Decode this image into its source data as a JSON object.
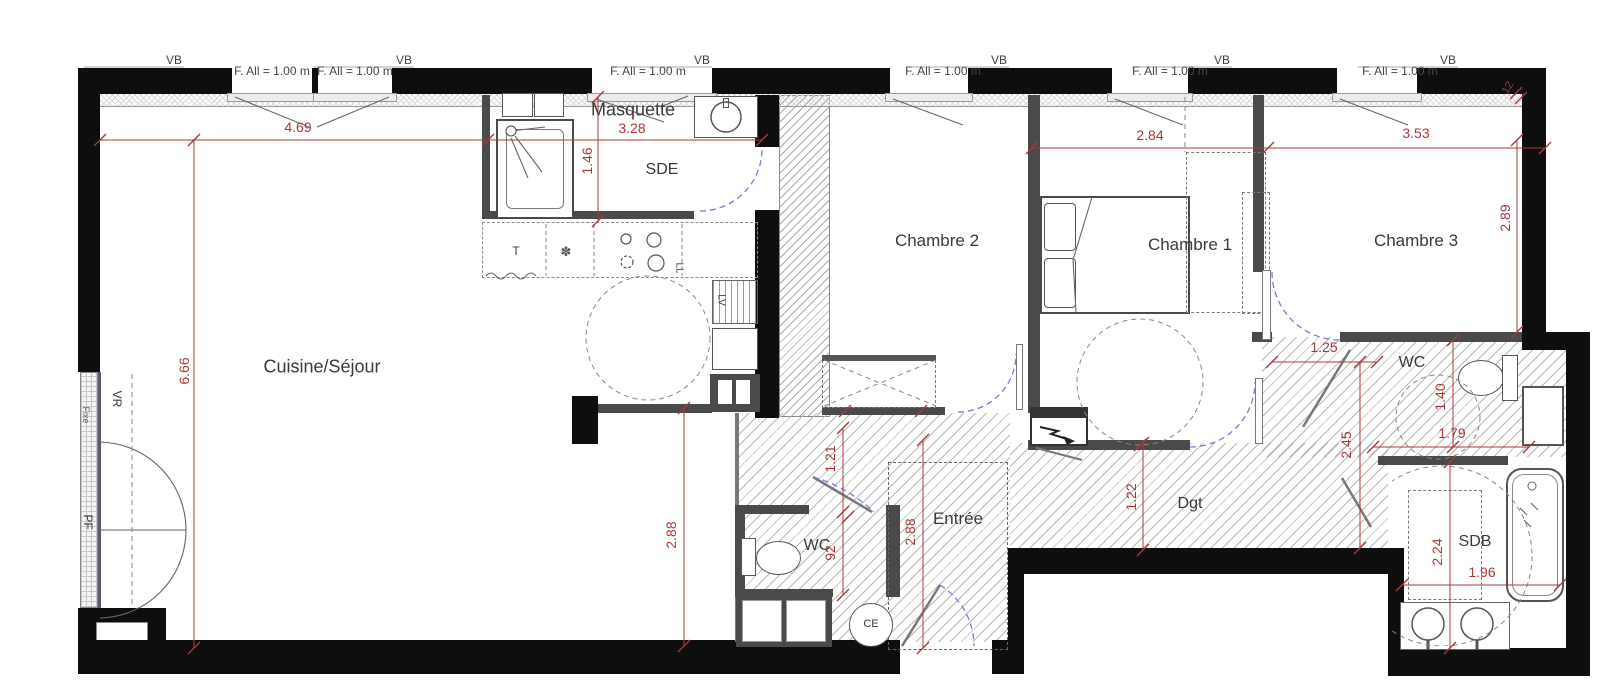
{
  "title": "Plan appartement 3 chambres",
  "colors": {
    "dimension_red": "#a83838",
    "wall_black": "#0e0e0e",
    "wall_gray": "#4a4a4a",
    "door_blue": "#7b7bd0",
    "label_gray": "#3a3a3a"
  },
  "windows": {
    "vb_label": "VB",
    "fall_label": "F. All = 1.00 m"
  },
  "rooms": {
    "cuisine_sejour": "Cuisine/Séjour",
    "sde": "SDE",
    "chambre2": "Chambre 2",
    "chambre1": "Chambre 1",
    "chambre3": "Chambre 3",
    "wc_bottom": "WC",
    "entree": "Entrée",
    "dgt": "Dgt",
    "wc_right": "WC",
    "sdb": "SDB"
  },
  "annotations": {
    "masquette": "Masquette",
    "ce": "CE",
    "table": "T",
    "flower": "✽",
    "ll": "LL",
    "lv": "LV",
    "vr": "VR",
    "pf": "PF",
    "fixe": "Fixe",
    "wall_note": "12"
  },
  "dimensions": {
    "sejour_width": "4.69",
    "sde_width": "3.28",
    "sde_depth": "1.46",
    "sejour_height": "6.66",
    "ch1_width": "2.84",
    "ch3_width": "3.53",
    "ch3_height": "2.89",
    "sejour_south": "2.88",
    "wc1_door": "1.21",
    "wc1_width": "92",
    "entree_height": "2.88",
    "dgt_width": "1.22",
    "ch3_passage": "1.25",
    "wc2_depth": "1.40",
    "wc2_width": "1.79",
    "corridor_depth": "2.45",
    "sdb_depth": "2.24",
    "sdb_width": "1.96"
  }
}
